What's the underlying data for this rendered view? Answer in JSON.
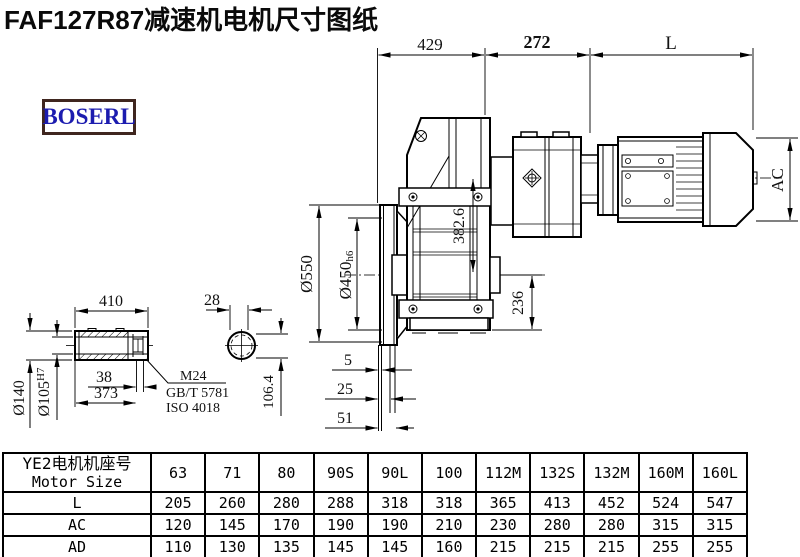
{
  "title": "FAF127R87减速机电机尺寸图纸",
  "logo": "BOSERL",
  "colors": {
    "logo_text": "#1c1caf",
    "logo_border": "#3f261f",
    "line": "#000000"
  },
  "drawing": {
    "top_dims": {
      "d429": "429",
      "d272": "272",
      "dL": "L"
    },
    "main_dims": {
      "ac": "AC",
      "d550": "Ø550",
      "d450": "Ø450",
      "d450_suffix": "h6",
      "d382": "382.6",
      "d236": "236",
      "d5": "5",
      "d25": "25",
      "d51": "51"
    },
    "shaft_dims": {
      "d410": "410",
      "d28": "28",
      "d140": "Ø140",
      "d105": "Ø105",
      "d105_suffix": "H7",
      "d38": "38",
      "d373": "373",
      "m24": "M24",
      "gbt": "GB/T 5781",
      "iso": "ISO 4018",
      "d106": "106.4"
    }
  },
  "table": {
    "header_cn": "YE2电机机座号",
    "header_en": "Motor Size",
    "sizes": [
      "63",
      "71",
      "80",
      "90S",
      "90L",
      "100",
      "112M",
      "132S",
      "132M",
      "160M",
      "160L"
    ],
    "rows": [
      {
        "label": "L",
        "values": [
          "205",
          "260",
          "280",
          "288",
          "318",
          "318",
          "365",
          "413",
          "452",
          "524",
          "547"
        ]
      },
      {
        "label": "AC",
        "values": [
          "120",
          "145",
          "170",
          "190",
          "190",
          "210",
          "230",
          "280",
          "280",
          "315",
          "315"
        ]
      },
      {
        "label": "AD",
        "values": [
          "110",
          "130",
          "135",
          "145",
          "145",
          "160",
          "215",
          "215",
          "215",
          "255",
          "255"
        ]
      }
    ]
  }
}
